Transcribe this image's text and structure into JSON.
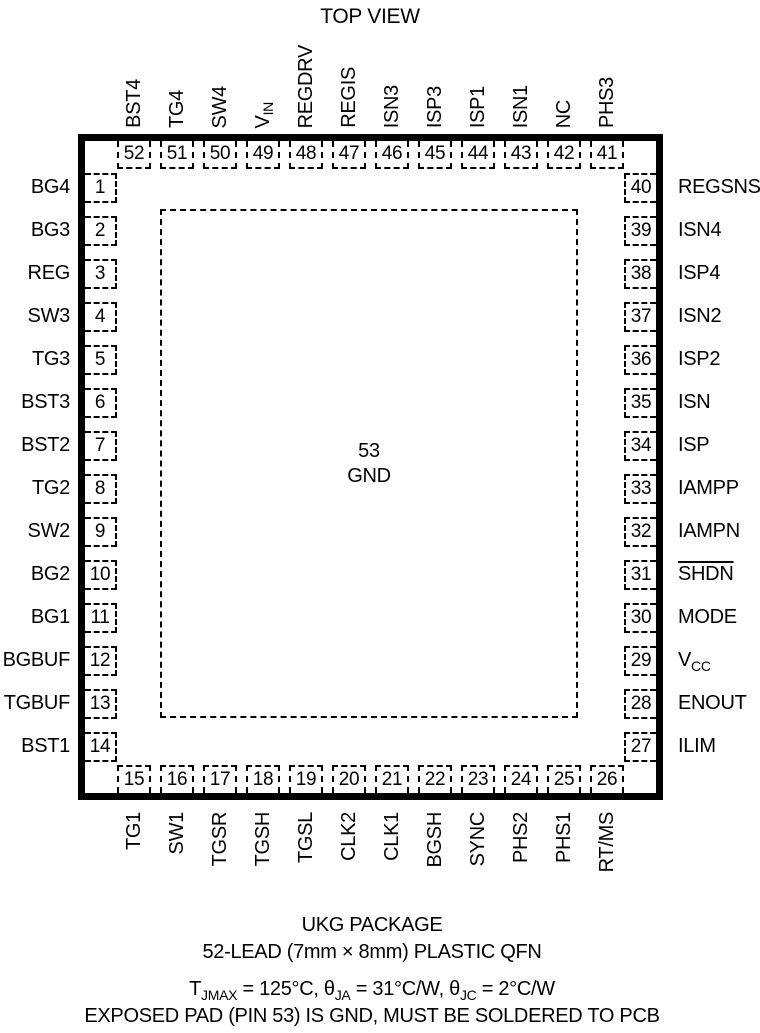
{
  "title": "TOP VIEW",
  "package": {
    "exposed_pad": {
      "number": "53",
      "name": "GND"
    },
    "pins": {
      "top": [
        {
          "num": "52",
          "name": "BST4"
        },
        {
          "num": "51",
          "name": "TG4"
        },
        {
          "num": "50",
          "name": "SW4"
        },
        {
          "num": "49",
          "name": "VIN",
          "base": "V",
          "sub": "IN"
        },
        {
          "num": "48",
          "name": "REGDRV"
        },
        {
          "num": "47",
          "name": "REGIS"
        },
        {
          "num": "46",
          "name": "ISN3"
        },
        {
          "num": "45",
          "name": "ISP3"
        },
        {
          "num": "44",
          "name": "ISP1"
        },
        {
          "num": "43",
          "name": "ISN1"
        },
        {
          "num": "42",
          "name": "NC"
        },
        {
          "num": "41",
          "name": "PHS3"
        }
      ],
      "left": [
        {
          "num": "1",
          "name": "BG4"
        },
        {
          "num": "2",
          "name": "BG3"
        },
        {
          "num": "3",
          "name": "REG"
        },
        {
          "num": "4",
          "name": "SW3"
        },
        {
          "num": "5",
          "name": "TG3"
        },
        {
          "num": "6",
          "name": "BST3"
        },
        {
          "num": "7",
          "name": "BST2"
        },
        {
          "num": "8",
          "name": "TG2"
        },
        {
          "num": "9",
          "name": "SW2"
        },
        {
          "num": "10",
          "name": "BG2"
        },
        {
          "num": "11",
          "name": "BG1"
        },
        {
          "num": "12",
          "name": "BGBUF"
        },
        {
          "num": "13",
          "name": "TGBUF"
        },
        {
          "num": "14",
          "name": "BST1"
        }
      ],
      "right": [
        {
          "num": "40",
          "name": "REGSNS"
        },
        {
          "num": "39",
          "name": "ISN4"
        },
        {
          "num": "38",
          "name": "ISP4"
        },
        {
          "num": "37",
          "name": "ISN2"
        },
        {
          "num": "36",
          "name": "ISP2"
        },
        {
          "num": "35",
          "name": "ISN"
        },
        {
          "num": "34",
          "name": "ISP"
        },
        {
          "num": "33",
          "name": "IAMPP"
        },
        {
          "num": "32",
          "name": "IAMPN"
        },
        {
          "num": "31",
          "name": "SHDN",
          "overline": true
        },
        {
          "num": "30",
          "name": "MODE"
        },
        {
          "num": "29",
          "name": "VCC",
          "base": "V",
          "sub": "CC"
        },
        {
          "num": "28",
          "name": "ENOUT"
        },
        {
          "num": "27",
          "name": "ILIM"
        }
      ],
      "bottom": [
        {
          "num": "15",
          "name": "TG1"
        },
        {
          "num": "16",
          "name": "SW1"
        },
        {
          "num": "17",
          "name": "TGSR"
        },
        {
          "num": "18",
          "name": "TGSH"
        },
        {
          "num": "19",
          "name": "TGSL"
        },
        {
          "num": "20",
          "name": "CLK2"
        },
        {
          "num": "21",
          "name": "CLK1"
        },
        {
          "num": "22",
          "name": "BGSH"
        },
        {
          "num": "23",
          "name": "SYNC"
        },
        {
          "num": "24",
          "name": "PHS2"
        },
        {
          "num": "25",
          "name": "PHS1"
        },
        {
          "num": "26",
          "name": "RT/MS"
        }
      ]
    }
  },
  "caption": {
    "line1": "UKG PACKAGE",
    "line2": "52-LEAD (7mm × 8mm) PLASTIC QFN",
    "line3_segments": [
      {
        "t": "T"
      },
      {
        "sub": "JMAX"
      },
      {
        "t": " = 125°C, θ"
      },
      {
        "sub": "JA"
      },
      {
        "t": " = 31°C/W, θ"
      },
      {
        "sub": "JC"
      },
      {
        "t": " = 2°C/W"
      }
    ],
    "line4": "EXPOSED PAD (PIN 53) IS GND, MUST BE SOLDERED TO PCB"
  },
  "colors": {
    "ink": "#000000",
    "background": "#ffffff"
  }
}
